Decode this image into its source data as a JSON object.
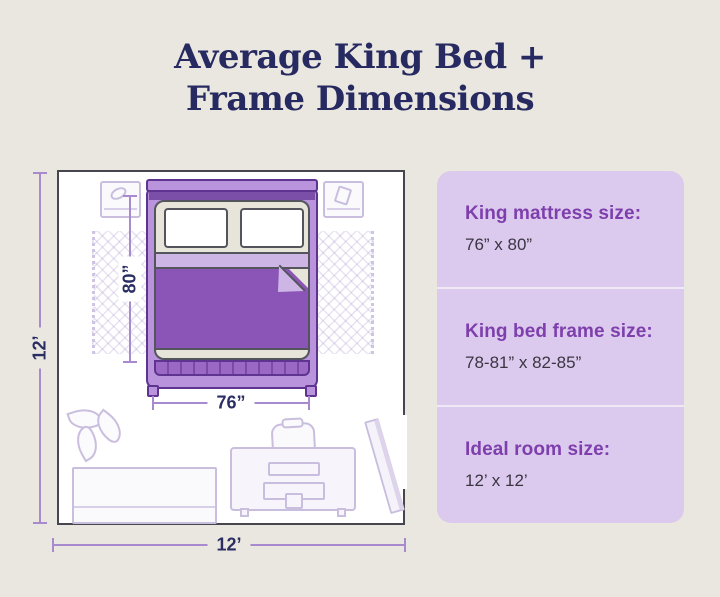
{
  "title": {
    "line1": "Average King Bed +",
    "line2": "Frame Dimensions"
  },
  "diagram": {
    "bed_length_label": "80”",
    "bed_width_label": "76”",
    "room_height_label": "12’",
    "room_width_label": "12’"
  },
  "sidebar": {
    "panels": [
      {
        "label": "King mattress size:",
        "value": "76” x 80”"
      },
      {
        "label": "King bed frame size:",
        "value": "78-81” x 82-85”"
      },
      {
        "label": "Ideal room size:",
        "value": "12’ x 12’"
      }
    ]
  },
  "colors": {
    "background": "#eae7e0",
    "title_navy": "#272a60",
    "panel_background": "#dccaee",
    "panel_heading_purple": "#7e3fad",
    "panel_value_gray": "#3a3542",
    "blanket_purple": "#8a55b7",
    "bed_frame_purple": "#b993dc",
    "dimension_line_purple": "#a78bce",
    "room_border_gray": "#47464e"
  }
}
